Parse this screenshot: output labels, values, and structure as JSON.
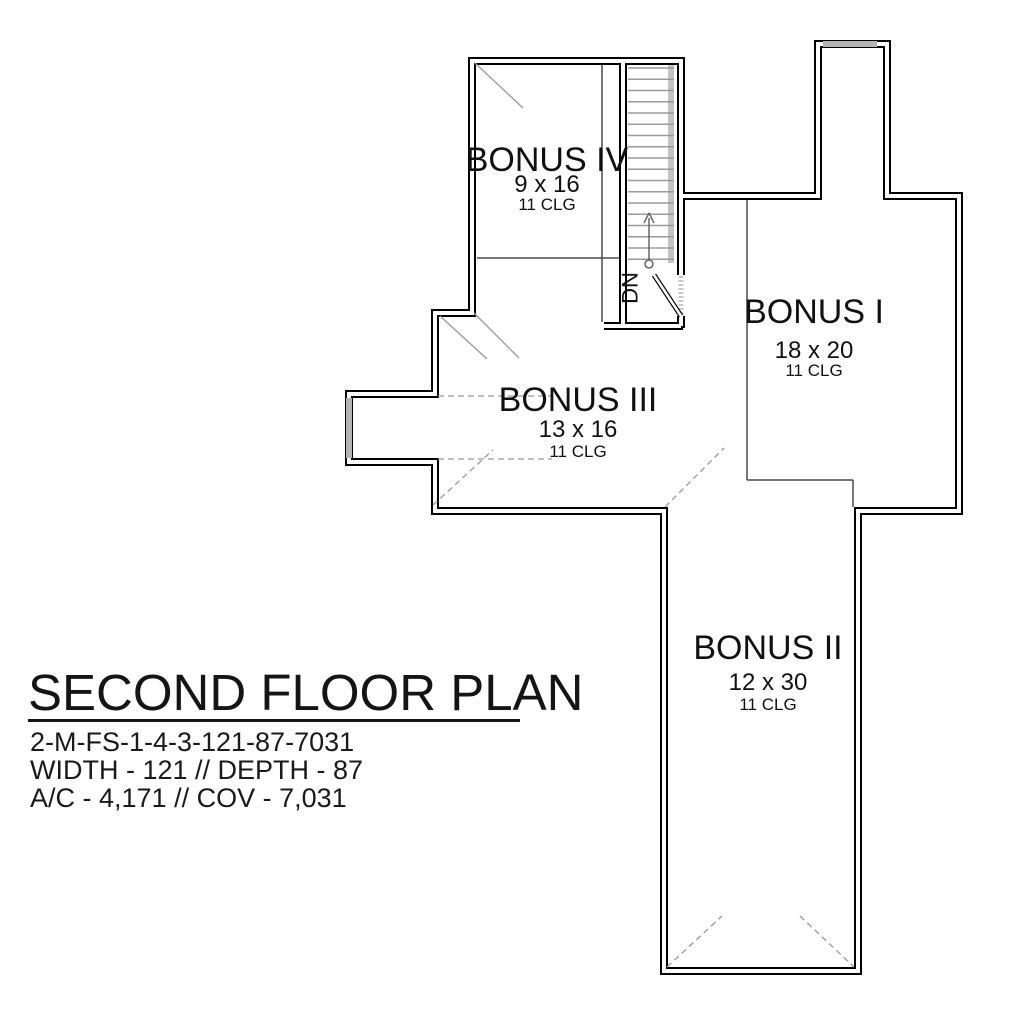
{
  "title_block": {
    "title": "SECOND FLOOR PLAN",
    "plan_number": "2-M-FS-1-4-3-121-87-7031",
    "dimensions_line": "WIDTH - 121 // DEPTH - 87",
    "area_line": "A/C - 4,171 // COV - 7,031"
  },
  "rooms": [
    {
      "name": "BONUS IV",
      "size": "9 x 16",
      "ceiling": "11 CLG"
    },
    {
      "name": "BONUS I",
      "size": "18 x 20",
      "ceiling": "11 CLG"
    },
    {
      "name": "BONUS III",
      "size": "13 x 16",
      "ceiling": "11 CLG"
    },
    {
      "name": "BONUS II",
      "size": "12 x 30",
      "ceiling": "11 CLG"
    }
  ],
  "stairs": {
    "direction_label": "DN"
  },
  "colors": {
    "wall": "#000000",
    "interior_line": "#4a4a4a",
    "break_line": "#999999",
    "window_fill": "#b4b4b4",
    "stair_tread": "#9a9a9a",
    "background": "#ffffff"
  }
}
